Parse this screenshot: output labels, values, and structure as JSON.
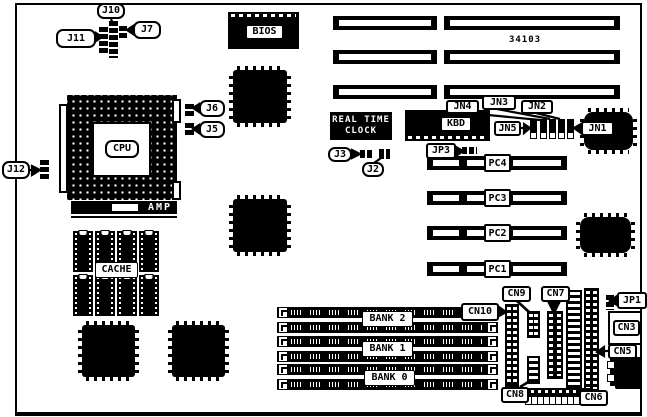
{
  "figure": {
    "type": "motherboard-jumper-connector-location-diagram",
    "part_number": "34103",
    "ink_color": "#000000",
    "paper_color": "#ffffff"
  },
  "chips": {
    "cpu": "CPU",
    "bios": "BIOS",
    "cache": "CACHE",
    "amp": "AMP",
    "kbd": "KBD",
    "rtc_line1": "REAL TIME",
    "rtc_line2": "CLOCK"
  },
  "slots": {
    "pc": [
      "PC4",
      "PC3",
      "PC2",
      "PC1"
    ],
    "banks": [
      "BANK 2",
      "BANK 1",
      "BANK 0"
    ]
  },
  "jumpers": {
    "j2": "J2",
    "j3": "J3",
    "j5": "J5",
    "j6": "J6",
    "j7": "J7",
    "j10": "J10",
    "j11": "J11",
    "j12": "J12",
    "jp1": "JP1",
    "jp3": "JP3"
  },
  "connectors": {
    "jn1": "JN1",
    "jn2": "JN2",
    "jn3": "JN3",
    "jn4": "JN4",
    "jn5": "JN5",
    "cn3": "CN3",
    "cn5": "CN5",
    "cn6": "CN6",
    "cn7": "CN7",
    "cn8": "CN8",
    "cn9": "CN9",
    "cn10": "CN10"
  }
}
